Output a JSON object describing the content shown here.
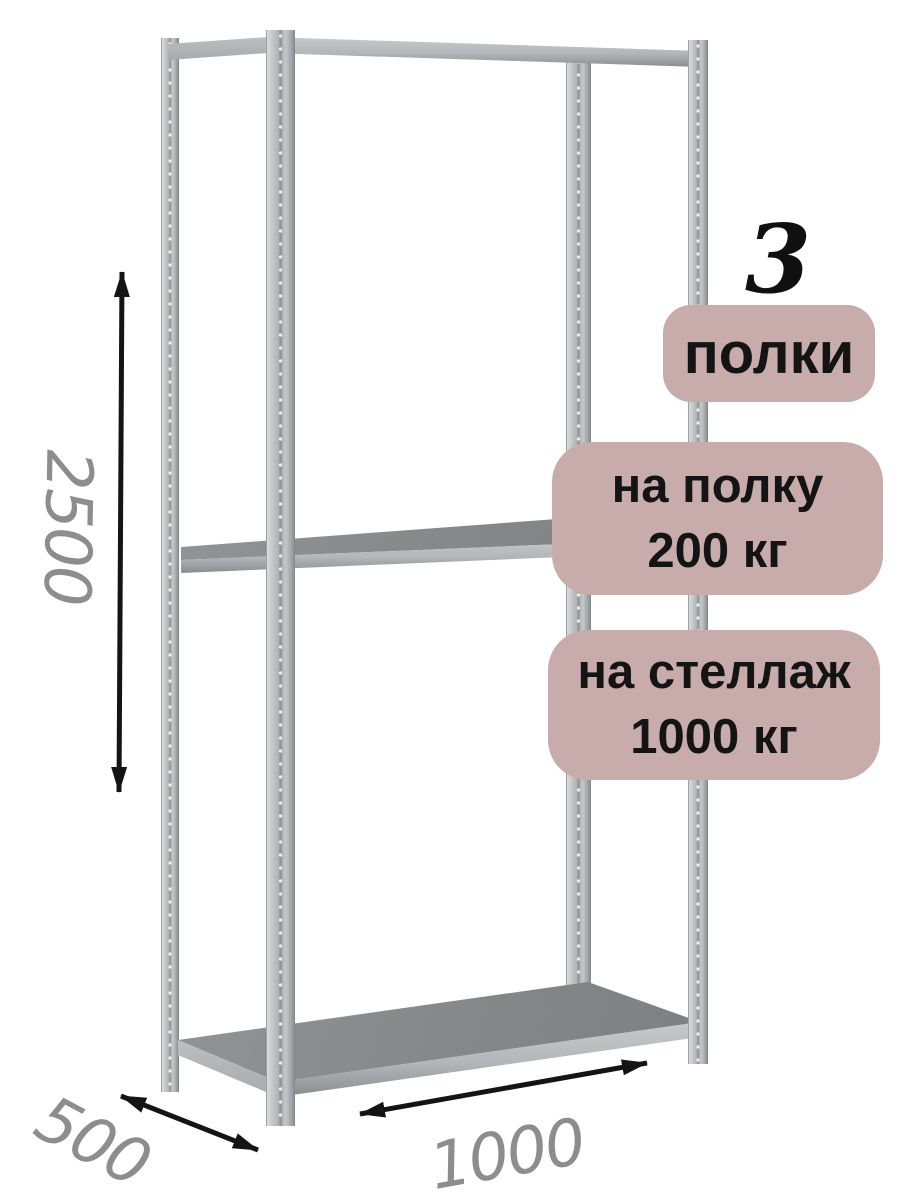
{
  "badges": {
    "shelves": {
      "count": "3",
      "label": "полки"
    },
    "shelf_load": {
      "line1": "на полку",
      "line2": "200 кг"
    },
    "rack_load": {
      "line1": "на стеллаж",
      "line2": "1000 кг"
    }
  },
  "dimensions": {
    "height_mm": "2500",
    "depth_mm": "500",
    "width_mm": "1000"
  },
  "icons": {
    "height_arrow": "double-headed-vertical-arrow",
    "depth_arrow": "double-headed-diagonal-arrow",
    "width_arrow": "double-headed-horizontal-arrow"
  },
  "colors": {
    "badge_bg": "#c8abab",
    "badge_text": "#141414",
    "dimension_text": "#8d8d8d",
    "arrow": "#141414",
    "metal_light": "#b8bbbd",
    "shelf_top": "#85888a",
    "background": "#ffffff"
  }
}
